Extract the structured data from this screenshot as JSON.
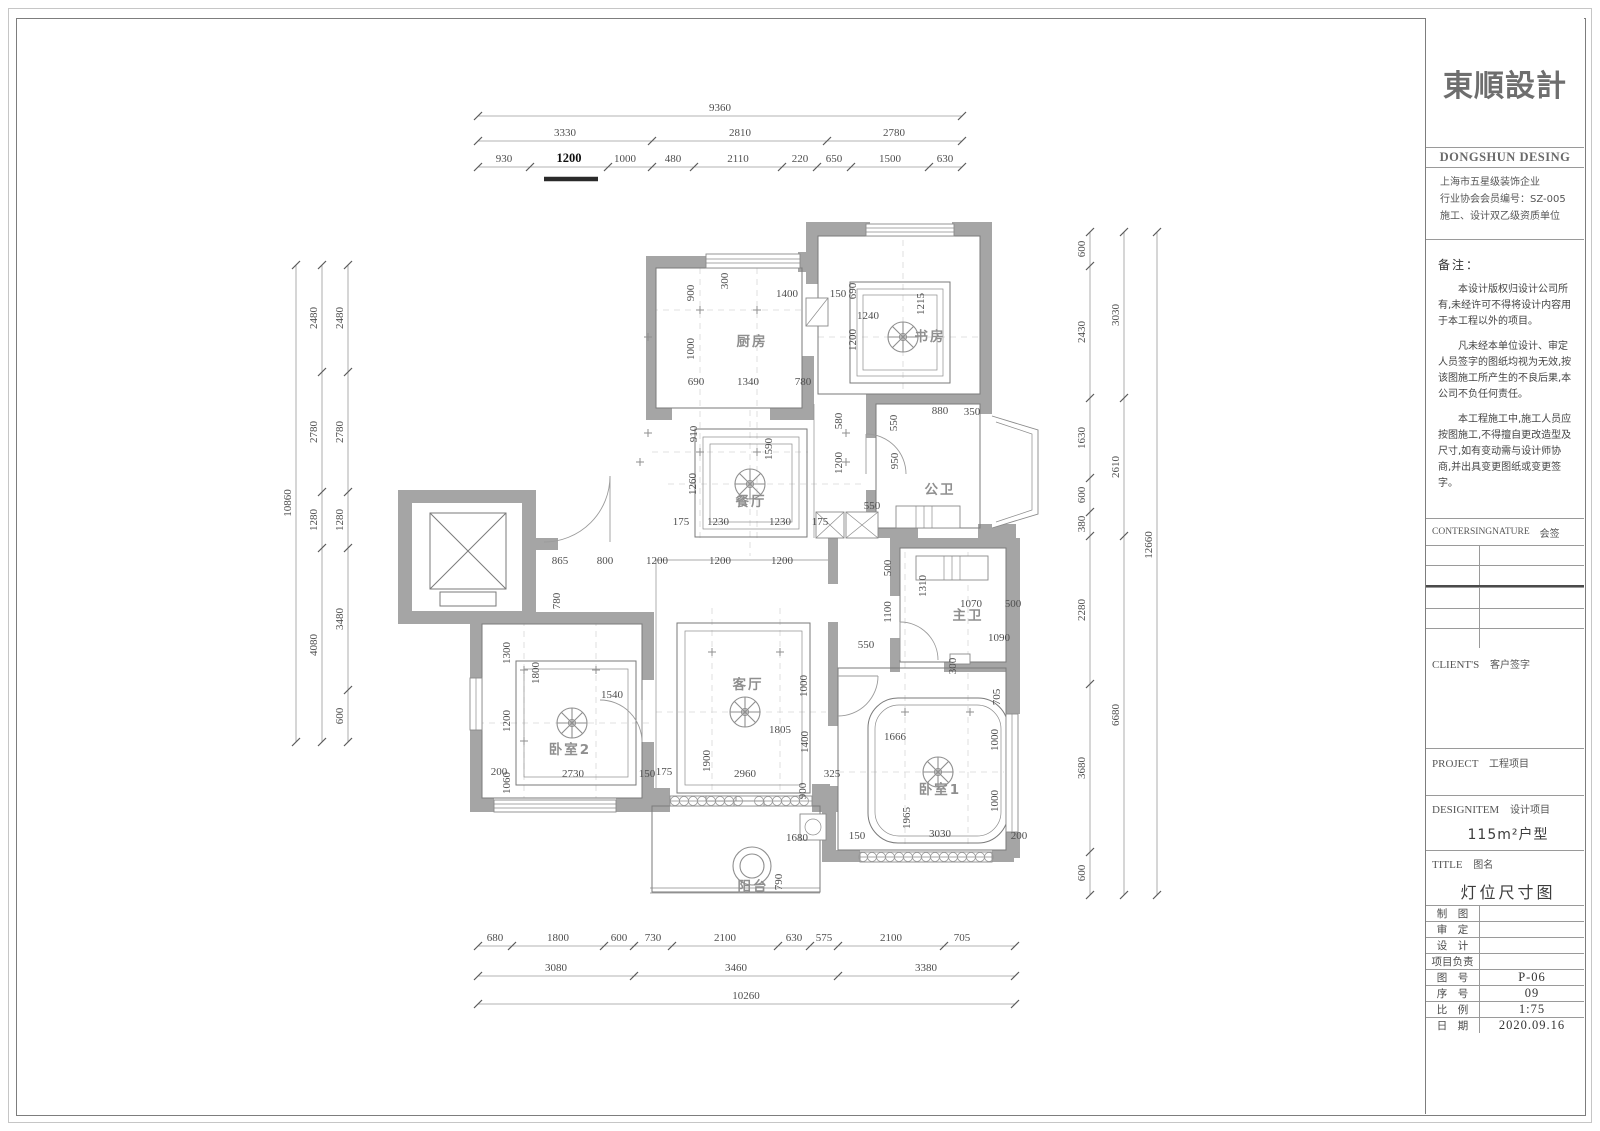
{
  "title_block": {
    "logo": "東順設計",
    "logo_en": "DONGSHUN DESING",
    "company_lines": [
      "上海市五星级装饰企业",
      "行业协会会员编号：SZ-005",
      "施工、设计双乙级资质单位"
    ],
    "notes_title": "备注：",
    "notes": [
      "本设计版权归设计公司所有,未经许可不得将设计内容用于本工程以外的项目。",
      "凡未经本单位设计、审定人员签字的图纸均视为无效,按该图施工所产生的不良后果,本公司不负任何责任。",
      "本工程施工中,施工人员应按图施工,不得擅自更改造型及尺寸,如有变动需与设计师协商,并出具变更图纸或变更签字。"
    ],
    "countersign_en": "CONTERSINGNATURE",
    "countersign_cn": "会签",
    "clients_en": "CLIENT'S",
    "clients_cn": "客户签字",
    "project_en": "PROJECT",
    "project_cn": "工程项目",
    "designitem_en": "DESIGNITEM",
    "designitem_cn": "设计项目",
    "designitem_value": "115m²户型",
    "title_en": "TITLE",
    "title_cn": "图名",
    "title_value": "灯位尺寸图",
    "info_rows": [
      {
        "label": "制　图",
        "value": ""
      },
      {
        "label": "审　定",
        "value": ""
      },
      {
        "label": "设　计",
        "value": ""
      },
      {
        "label": "项目负责",
        "value": ""
      },
      {
        "label": "图　号",
        "value": "P-06"
      },
      {
        "label": "序　号",
        "value": "09"
      },
      {
        "label": "比　例",
        "value": "1:75"
      },
      {
        "label": "日　期",
        "value": "2020.09.16"
      }
    ]
  },
  "plan": {
    "rooms": [
      {
        "id": "kitchen",
        "label": "厨房"
      },
      {
        "id": "study",
        "label": "书房"
      },
      {
        "id": "dining",
        "label": "餐厅"
      },
      {
        "id": "public-bath",
        "label": "公卫"
      },
      {
        "id": "master-bath",
        "label": "主卫"
      },
      {
        "id": "living",
        "label": "客厅"
      },
      {
        "id": "bedroom1",
        "label": "卧室1"
      },
      {
        "id": "bedroom2",
        "label": "卧室2"
      },
      {
        "id": "balcony",
        "label": "阳台"
      }
    ],
    "dims": {
      "top_overall": "9360",
      "top_row2": [
        "3330",
        "2810",
        "2780"
      ],
      "top_row3": [
        "930",
        "1200",
        "1000",
        "480",
        "2110",
        "220",
        "650",
        "1500",
        "630"
      ],
      "bottom_row1": [
        "680",
        "1800",
        "600",
        "730",
        "2100",
        "630",
        "575",
        "2100",
        "705"
      ],
      "bottom_row2": [
        "3080",
        "3460",
        "3380"
      ],
      "bottom_overall": "10260",
      "left_overall": "10860",
      "left_col2": [
        "2480",
        "2780",
        "1280",
        "4080"
      ],
      "left_col3": [
        "2480",
        "2780",
        "1280",
        "3480",
        "600"
      ],
      "right_col1": [
        "600",
        "2430",
        "1630",
        "600",
        "380",
        "2280",
        "3680",
        "600"
      ],
      "right_col2": [
        "3030",
        "2610",
        "6680"
      ],
      "right_overall": "12660",
      "inner": [
        "300",
        "900",
        "1400",
        "150",
        "1000",
        "690",
        "1340",
        "780",
        "690",
        "1215",
        "1240",
        "1200",
        "910",
        "1590",
        "1260",
        "175",
        "1230",
        "1230",
        "175",
        "580",
        "1200",
        "550",
        "550",
        "950",
        "880",
        "350",
        "865",
        "800",
        "1200",
        "1200",
        "1200",
        "780",
        "500",
        "1100",
        "550",
        "1310",
        "1070",
        "500",
        "1090",
        "300",
        "1300",
        "1800",
        "1540",
        "1200",
        "200",
        "2730",
        "150",
        "175",
        "1060",
        "1000",
        "1805",
        "1400",
        "1900",
        "2960",
        "900",
        "325",
        "705",
        "1666",
        "1000",
        "1000",
        "1965",
        "3030",
        "150",
        "200",
        "1680",
        "790"
      ]
    }
  }
}
